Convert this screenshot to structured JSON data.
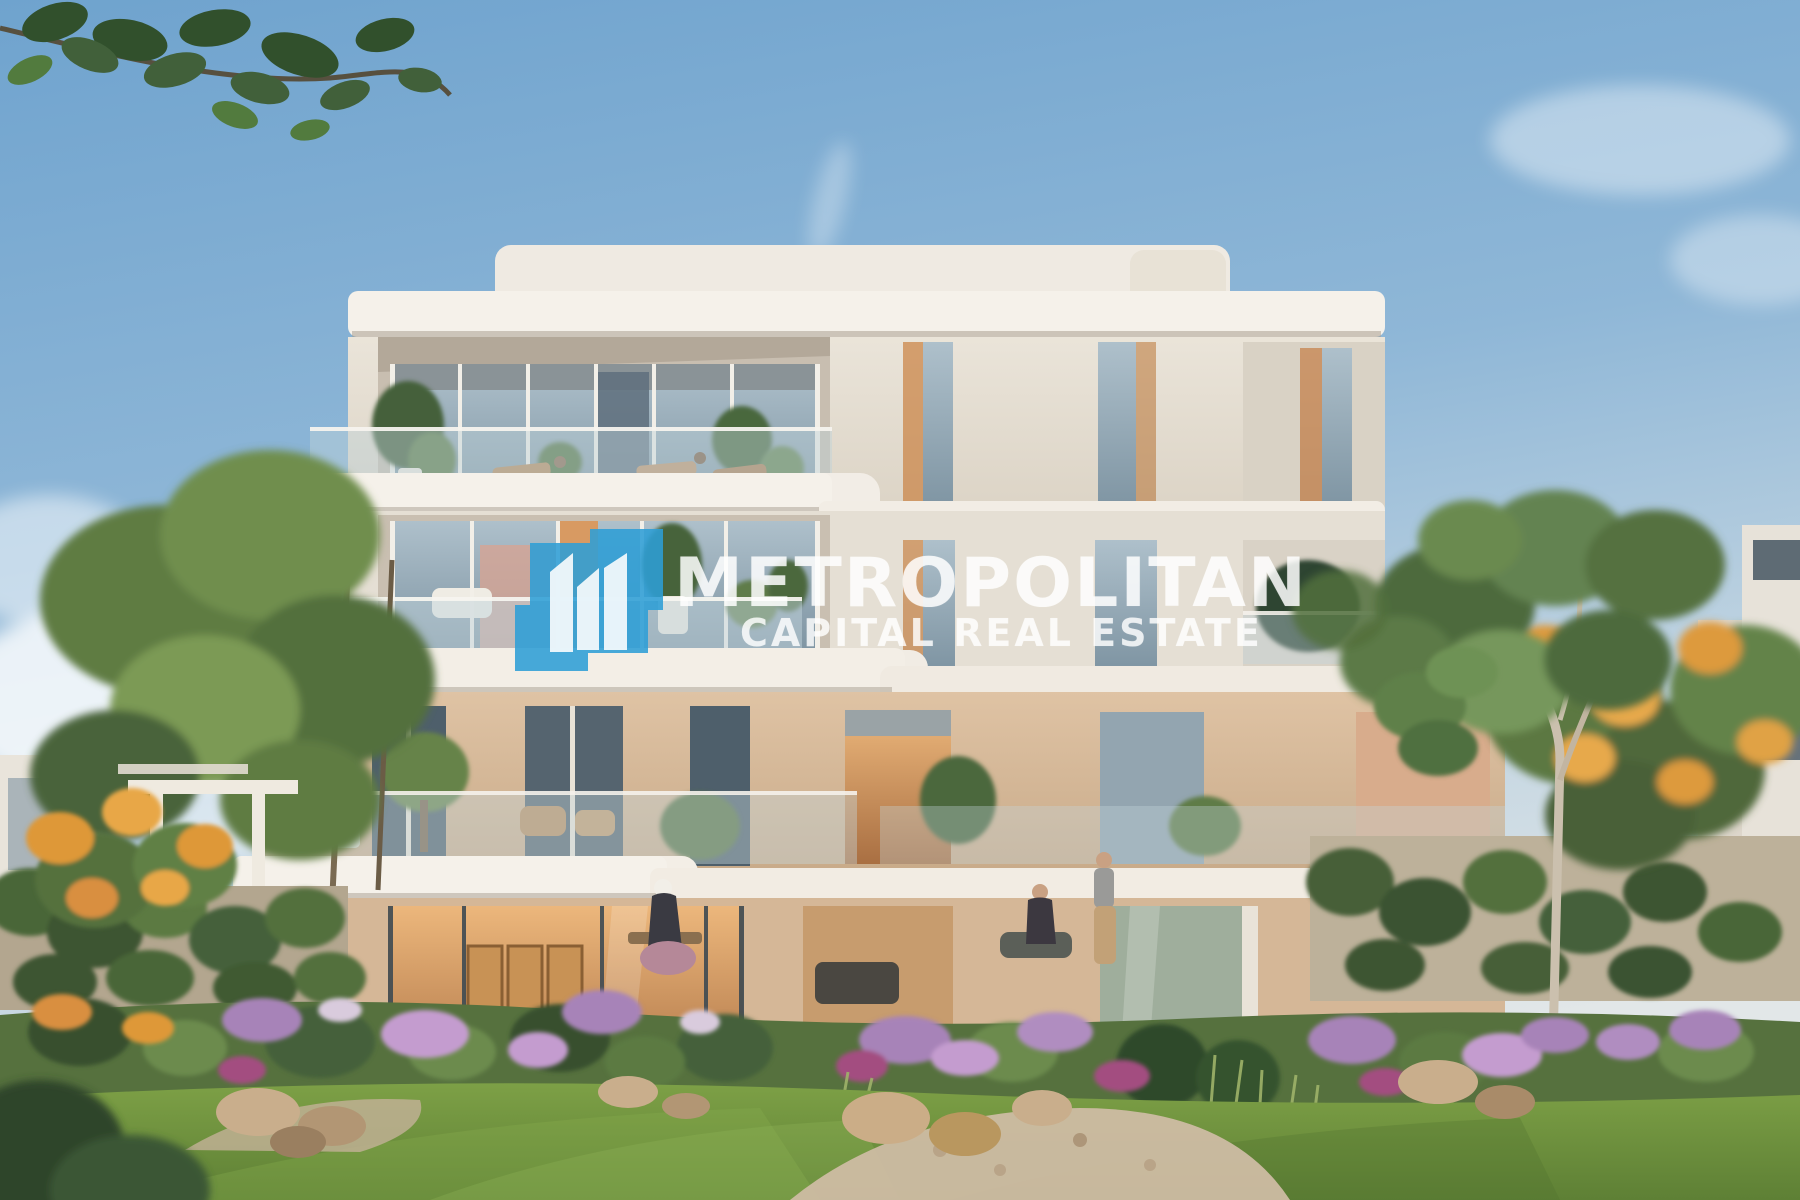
{
  "image": {
    "kind": "architectural-rendering-photo",
    "subject": "Modern four-storey residential building with glass balconies, roof terrace, landscaped garden, flowering trees, lawn and people on the terraces",
    "watermark": {
      "brand": "METROPOLITAN",
      "tagline": "CAPITAL REAL ESTATE",
      "icon": "buildings-icon",
      "icon_color": "#2D9ED6",
      "text_color": "#FFFFFF"
    },
    "palette": {
      "sky_top": "#6FA3CE",
      "sky_horizon": "#DFE6E8",
      "wall_white": "#EDE8E0",
      "wall_shadow": "#CFC6B8",
      "wall_beige": "#D8BC9E",
      "wall_terracotta": "#D8AC8C",
      "glass_blue": "#93A7B4",
      "glass_warm": "#D9A569",
      "foliage_dark": "#3C5530",
      "foliage_light": "#7B9A54",
      "flowers_purple": "#A783B8",
      "flowers_magenta": "#A34E80",
      "flowers_orange": "#DE9838",
      "lawn_green": "#6E9040",
      "rock": "#C9AE8C",
      "gravel": "#CDBCA3"
    }
  }
}
